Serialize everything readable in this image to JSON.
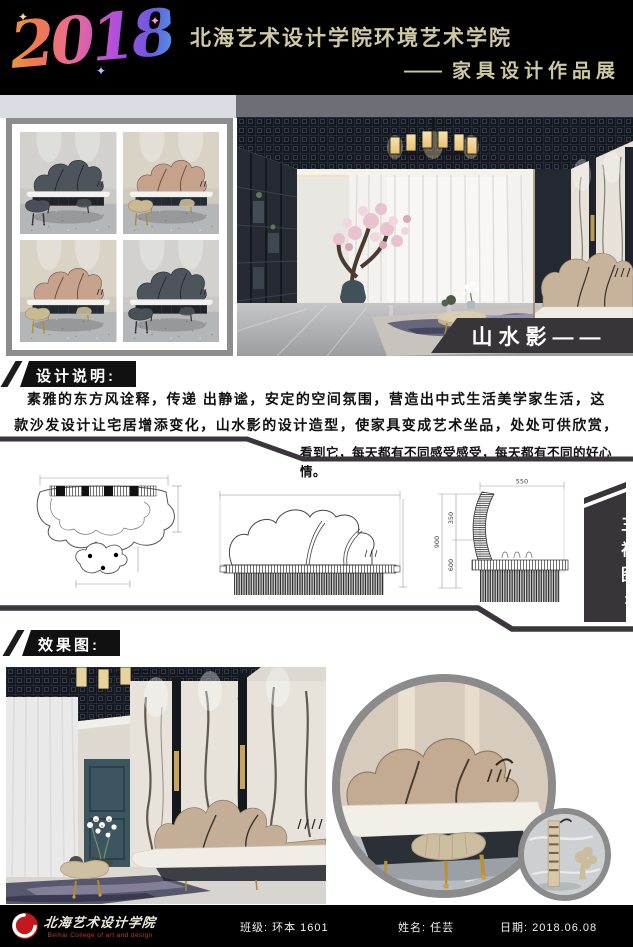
{
  "header": {
    "year": "2018",
    "title": "北海艺术设计学院环境艺术学院",
    "subtitle_dash": "——",
    "subtitle": "家具设计作品展"
  },
  "product": {
    "label": "山水影——"
  },
  "notes": {
    "heading": "设计说明:",
    "lines": [
      "素雅的东方风诠释，传递 出静谧，安定的空间氛围，营造出中式生活美学家生活，这",
      "款沙发设计让宅居增添变化，山水影的设计造型，使家具变成艺术坐品，处处可供欣赏，",
      "看到它，每天都有不同感受感受，每天都有不同的好心情。"
    ]
  },
  "views": {
    "label": "三视图:",
    "dims": {
      "width_top": "550",
      "back_height": "350",
      "total_height": "900",
      "seat_height": "600"
    }
  },
  "effects": {
    "heading": "效果图:"
  },
  "footer": {
    "school_cn": "北海艺术设计学院",
    "school_en": "Beihai College of art and design",
    "class_field": "班级: 环本 1601",
    "name_field": "姓名: 任芸",
    "date_field": "日期: 2018.06.08"
  },
  "colors": {
    "accent": "#38353a",
    "khaki": "#cfc8a5",
    "ring": "#8b8b8b",
    "red": "#c4161c",
    "divider": "#3a363b"
  },
  "variants": [
    {
      "wall": "#d2d1ce",
      "back": "#4e545c",
      "seam": "#262a30",
      "basedark": "#202329",
      "table": "#4b5057",
      "tableEdge": "#30343a",
      "legs": "#2c2f34"
    },
    {
      "wall": "#d9d3c6",
      "back": "#c6a28c",
      "seam": "#6b4f40",
      "basedark": "#252b33",
      "table": "#c9ba92",
      "tableEdge": "#9d8d66",
      "legs": "#b08a2e"
    },
    {
      "wall": "#d9d3c6",
      "back": "#c6a28c",
      "seam": "#6b4f40",
      "basedark": "#252b33",
      "table": "#c9ba92",
      "tableEdge": "#9d8d66",
      "legs": "#b08a2e"
    },
    {
      "wall": "#d2d1ce",
      "back": "#4e545c",
      "seam": "#262a30",
      "basedark": "#202329",
      "table": "#4b5057",
      "tableEdge": "#30343a",
      "legs": "#2c2f34"
    }
  ]
}
